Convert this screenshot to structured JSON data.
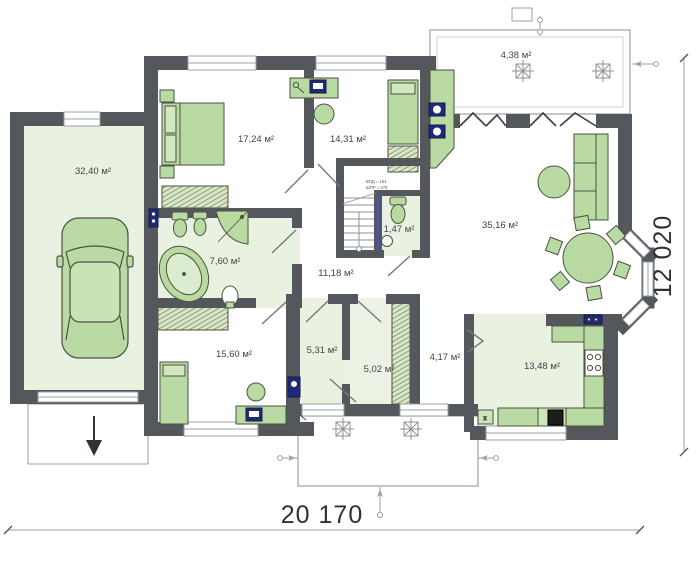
{
  "title": "Ground floor plan",
  "dims": {
    "width": "20 170",
    "height": "12 020"
  },
  "rooms": {
    "garage": {
      "area": "32,40 м²"
    },
    "bedroom1": {
      "area": "17,24 м²"
    },
    "office": {
      "area": "14,31 м²"
    },
    "terrace": {
      "area": "4,38 м²"
    },
    "living": {
      "area": "35,16 м²"
    },
    "wc": {
      "area": "1,47 м²"
    },
    "bathroom": {
      "area": "7,60 м²"
    },
    "corridor": {
      "area": "11,18 м²"
    },
    "bedroom2": {
      "area": "15,60 м²"
    },
    "utility": {
      "area": "5,31 м²"
    },
    "wardrobe": {
      "area": "5,02 м²"
    },
    "hall": {
      "area": "4,17 м²"
    },
    "kitchen": {
      "area": "13,48 м²"
    }
  },
  "stairs": {
    "note_line1": "ВПД = 181",
    "note_line2": "ШПР = 278"
  },
  "colors": {
    "wall": "#54585c",
    "room_tint": "#e9f1e1",
    "furniture": "#b9dba3",
    "furniture_stroke": "#4a5240",
    "appliance": "#1e2a78",
    "hatch_line": "#5d6b4a",
    "dimension_line": "#9aa0a6",
    "label_text": "#3f4449"
  }
}
